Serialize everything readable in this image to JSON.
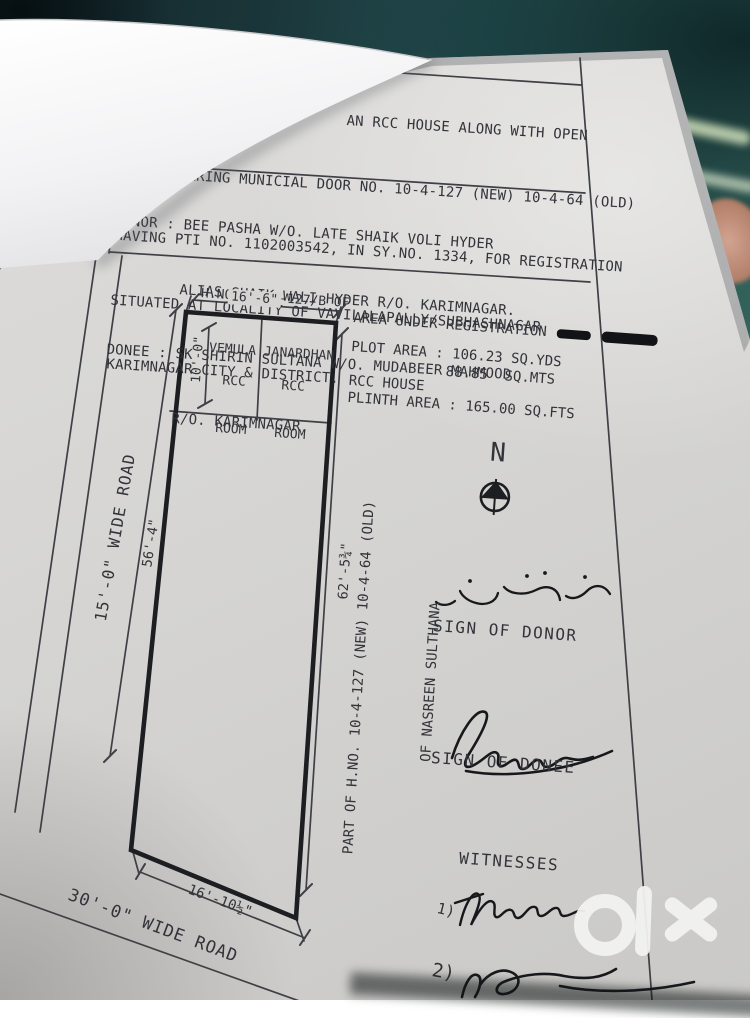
{
  "colors": {
    "paper": "#d6d5d3",
    "ink": "#33343a",
    "background_teal": "#245052",
    "watermark_white": "#f2f2f2"
  },
  "title_block": {
    "lines": [
      "AN SHOWING THE            AN RCC HOUSE ALONG WITH OPEN",
      "PLACE BEARING MUNICIAL DOOR NO. 10-4-127 (NEW) 10-4-64 (OLD)",
      "HAVING PTI NO. 1102003542, IN SY.NO. 1334, FOR REGISTRATION",
      "SITUATED AT LOCALITY OF VAVILALAPALLY/SUBHASHNAGAR",
      "KARIMNAGAR CITY & DISTRICT."
    ]
  },
  "party_block": {
    "lines": [
      "DONOR : BEE PASHA W/O. LATE SHAIK VOLI HYDER",
      "        ALIAS SHAIK WALI HYDER R/O. KARIMNAGAR.",
      "DONEE : SK SHIRIN SULTANA W/O. MUDABEER MAHMOOD",
      "        R/O. KARIMNAGAR."
    ]
  },
  "plan": {
    "adjacent_top_line1": "H.NO. 10-4-127/B OF",
    "adjacent_top_line2": "VEMULA JANARDHAN",
    "dim_top_width": "16'-6\"",
    "dim_room_depth": "10'-0\"",
    "room_label_line1": "RCC",
    "room_label_line2": "ROOM",
    "dim_left_side": "56'-4\"",
    "road_left": "15'-0\" WIDE ROAD",
    "dim_right_side": "62'-5¾\"",
    "adjacent_right_line1": "PART OF H.NO. 10-4-127 (NEW) 10-4-64 (OLD)",
    "adjacent_right_line2": "OF NASREEN SULTHANA",
    "dim_bottom_width": "16'-10½\"",
    "road_bottom": "30'-0\" WIDE ROAD",
    "north_indicator": "N"
  },
  "registration": {
    "legend_label": "AREA UNDER REGISTRATION",
    "plot_area_line": "PLOT AREA : 106.23 SQ.YDS",
    "plot_area_mts_line": "88.85  SQ.MTS",
    "house_line": "RCC HOUSE",
    "plinth_line": "PLINTH AREA : 165.00 SQ.FTS"
  },
  "signatures": {
    "donor_caption": "SIGN OF DONOR",
    "donee_caption": "SIGN OF DONEE",
    "witnesses_heading": "WITNESSES",
    "witness1_index": "1)",
    "witness2_index": "2)"
  },
  "watermark": {
    "brand": "olx"
  }
}
